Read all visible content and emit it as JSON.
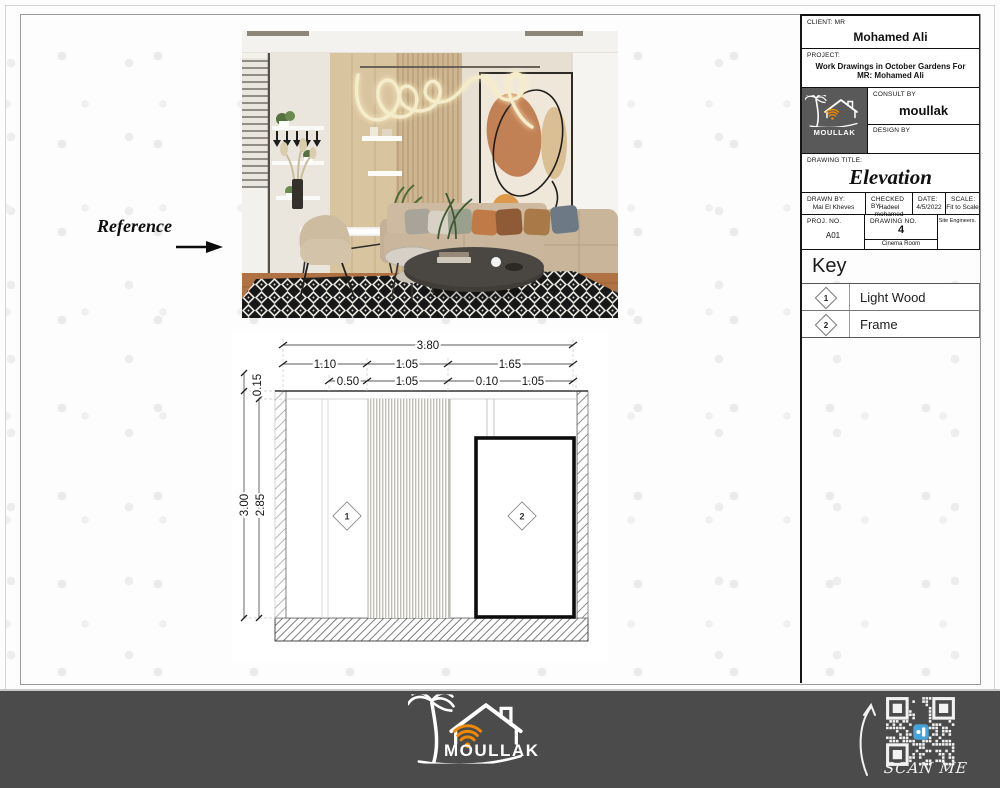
{
  "colors": {
    "accent_orange": "#ef8a00",
    "footer_bg": "#4b4b4b",
    "logo_bg": "#595959",
    "neon": "#f4ecca"
  },
  "reference": {
    "label": "Reference"
  },
  "title_block": {
    "client_label": "CLIENT: MR",
    "client_name": "Mohamed Ali",
    "project_label": "PROJECT:",
    "project_name": "Work Drawings in October Gardens For MR: Mohamed Ali",
    "consult_label": "CONSULT BY",
    "consult_value": "moullak",
    "design_label": "DESIGN BY",
    "drawing_title_label": "DRAWING TITLE:",
    "drawing_title": "Elevation",
    "drawn_by_label": "DRAWN BY:",
    "drawn_by_value": "Mai El Kheves",
    "checked_by_label": "CHECKED BY:",
    "checked_by_value": "Hadeel mohamed",
    "date_label": "DATE:",
    "date_value": "4/5/2022",
    "scale_label": "SCALE:",
    "scale_value": "Fit to Scale",
    "proj_no_label": "PROJ. NO.",
    "proj_no_value": "A01",
    "drawing_no_label": "DRAWING NO.",
    "drawing_no_value": "4",
    "drawing_no_room": "Cinema Room",
    "site_engineers_label": "Site Engineers."
  },
  "key": {
    "heading": "Key",
    "items": [
      {
        "tag": "1",
        "label": "Light Wood"
      },
      {
        "tag": "2",
        "label": "Frame"
      }
    ]
  },
  "elevation": {
    "dim_total": "3.80",
    "dims_row2": [
      "1.10",
      "1.05",
      "1.65"
    ],
    "dims_row3": [
      "0.50",
      "1.05",
      "0.10",
      "1.05"
    ],
    "dims_vertical": [
      "0.15",
      "3.00",
      "2.85"
    ],
    "tag1": "1",
    "tag2": "2"
  },
  "brand": {
    "name": "MOULLAK"
  },
  "qr": {
    "scan_label": "SCAN ME"
  }
}
